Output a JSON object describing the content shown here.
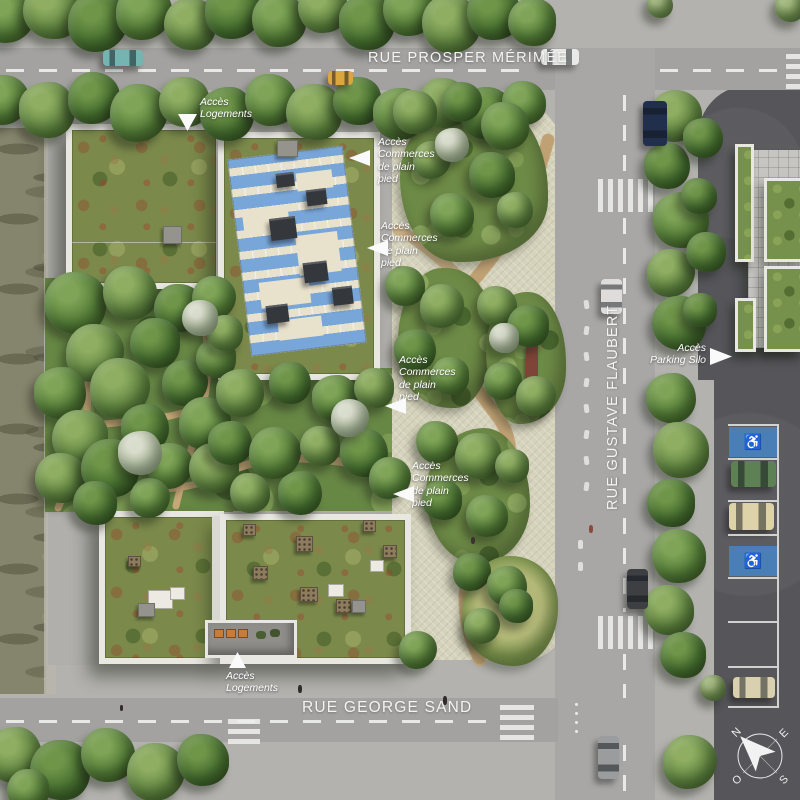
{
  "streets": {
    "top": "RUE PROSPER MÉRIMÉE",
    "right": "RUE GUSTAVE FLAUBERT",
    "bottom": "RUE GEORGE SAND"
  },
  "annotations": [
    {
      "id": "acces-logements-top",
      "lines": [
        "Accès",
        "Logements"
      ]
    },
    {
      "id": "acces-commerces-1",
      "lines": [
        "Accès",
        "Commerces",
        "de plain",
        "pied"
      ]
    },
    {
      "id": "acces-commerces-2",
      "lines": [
        "Accès",
        "Commerces",
        "de plain",
        "pied"
      ]
    },
    {
      "id": "acces-commerces-3",
      "lines": [
        "Accès",
        "Commerces",
        "de plain",
        "pied"
      ]
    },
    {
      "id": "acces-commerces-4",
      "lines": [
        "Accès",
        "Commerces",
        "de plain",
        "pied"
      ]
    },
    {
      "id": "acces-parking-silo",
      "lines": [
        "Accès",
        "Parking Silo"
      ]
    },
    {
      "id": "acces-logements-bottom",
      "lines": [
        "Accès",
        "Logements"
      ]
    }
  ],
  "compass": {
    "north": "N",
    "east": "E",
    "south": "S",
    "west": "O"
  },
  "icons": {
    "wheelchair": "♿"
  },
  "colors": {
    "plaza": "#d6d3bc",
    "road": "#a3a2a0",
    "dark_lot": "#56565a",
    "solar_blue": "#79a6d9",
    "sedum_green": "#7b8a4b",
    "handicap_blue": "#4a7fb5",
    "path_tan": "#c9ab80"
  }
}
